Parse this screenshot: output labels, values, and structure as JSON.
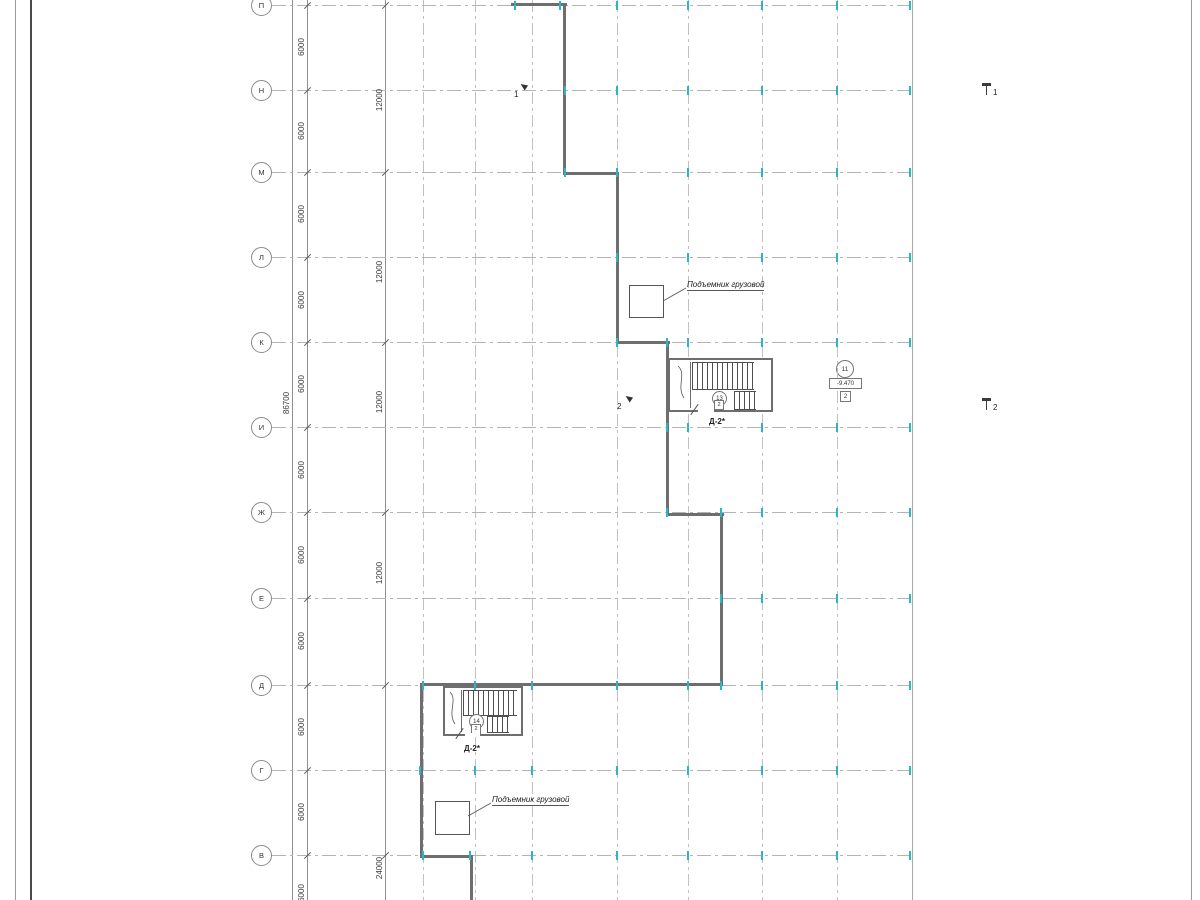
{
  "grid": {
    "row_labels": [
      "П",
      "Н",
      "М",
      "Л",
      "К",
      "И",
      "Ж",
      "Е",
      "Д",
      "Г",
      "В"
    ]
  },
  "dims": {
    "left_chain": [
      "6000",
      "6000",
      "6000",
      "6000",
      "6000",
      "6000",
      "6000",
      "6000",
      "6000",
      "6000",
      "6000"
    ],
    "mid_chain": [
      "12000",
      "12000",
      "12000",
      "12000",
      "24000"
    ],
    "total": "86700"
  },
  "stair_upper": {
    "position_tag": "13",
    "door_mark": "2",
    "name": "Д-2*"
  },
  "stair_lower": {
    "position_tag": "14",
    "door_mark": "2",
    "name": "Д-2*"
  },
  "lift_upper": {
    "label": "Подъемник грузовой"
  },
  "lift_lower": {
    "label": "Подъемник грузовой"
  },
  "sections": {
    "top": "1",
    "right_upper": "1",
    "left_mid": "2",
    "right_mid": "2"
  },
  "level_group": {
    "position": "11",
    "elevation": "-9.470",
    "mark": "2"
  },
  "colors": {
    "wall": "#6e6e6e",
    "grid_line": "#b4b4b4",
    "cyan_tick": "#2bb6c4",
    "text": "#333333"
  }
}
